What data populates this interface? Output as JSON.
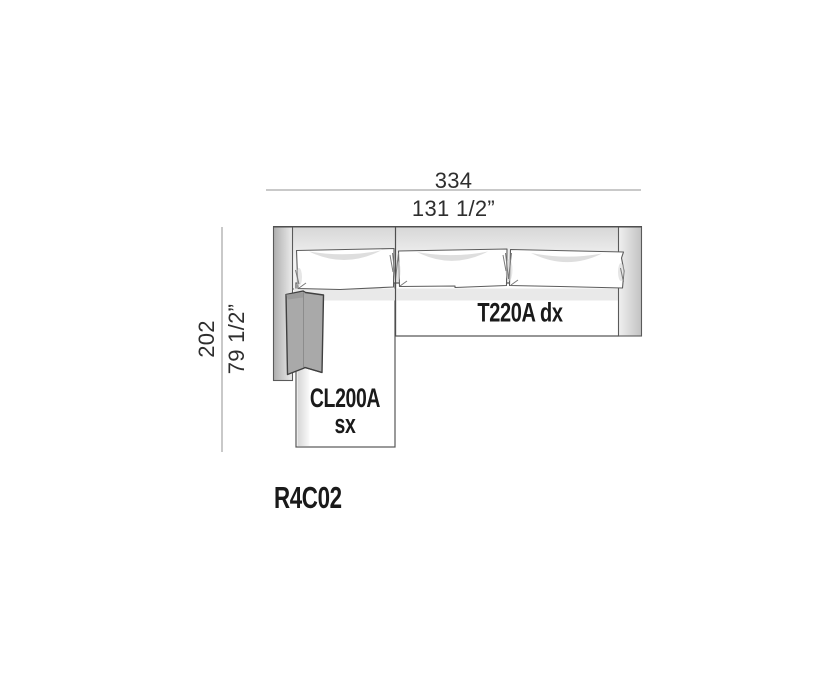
{
  "diagram": {
    "model_code": "R4C02",
    "dimensions": {
      "width": {
        "cm": "334",
        "inches": "131 1/2”"
      },
      "depth": {
        "cm": "202",
        "inches": "79 1/2”"
      }
    },
    "modules": [
      {
        "label": "T220A dx"
      },
      {
        "label": "CL200A",
        "sublabel": "sx"
      }
    ],
    "colors": {
      "dimension_line": "#c9c9c9",
      "dimension_text": "#2e2e2e",
      "outline": "#555555",
      "label_text": "#1a1a1a",
      "lumbar_cushion": "#a9a9a9",
      "seat_shadow_band": "#e9e9e9"
    }
  }
}
